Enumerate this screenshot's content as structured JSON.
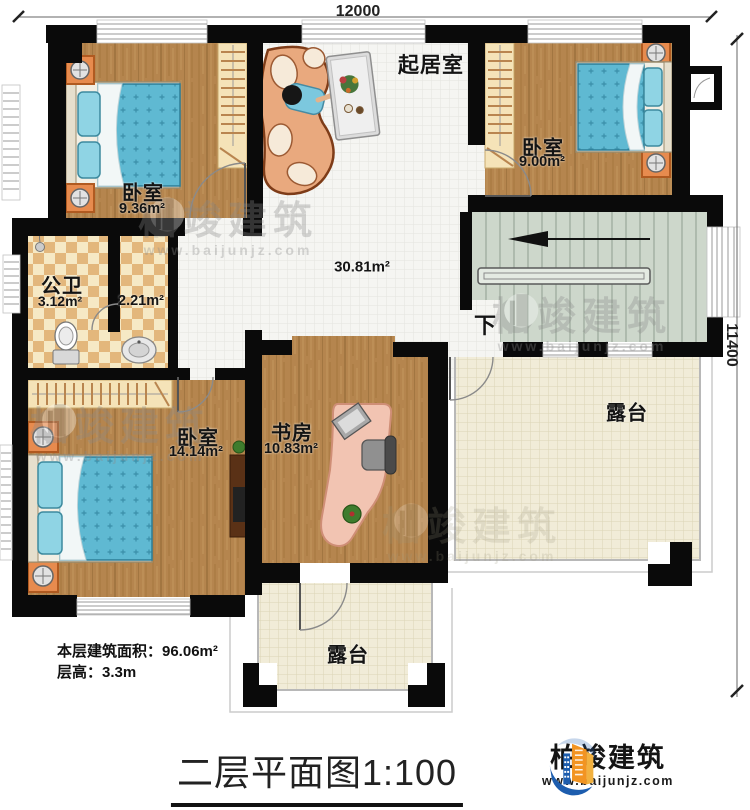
{
  "dimensions": {
    "width_label": "12000",
    "height_label": "11400"
  },
  "rooms": {
    "bedroom_tl": {
      "name": "卧室",
      "area": "9.36m²"
    },
    "living": {
      "name": "起居室",
      "area": "30.81m²"
    },
    "bedroom_tr": {
      "name": "卧室",
      "area": "9.00m²"
    },
    "bathroom": {
      "name": "公卫",
      "area": "3.12m²"
    },
    "washroom": {
      "area": "2.21m²"
    },
    "bedroom_bl": {
      "name": "卧室",
      "area": "14.14m²"
    },
    "study": {
      "name": "书房",
      "area": "10.83m²"
    },
    "terrace_right": {
      "name": "露台"
    },
    "terrace_bottom": {
      "name": "露台"
    }
  },
  "stairs": {
    "direction_label": "下"
  },
  "notes": {
    "building_area": "本层建筑面积：96.06m²",
    "floor_height": "层高：3.3m"
  },
  "title": {
    "name": "二层平面图",
    "scale": "1:100"
  },
  "brand": {
    "name": "柏竣建筑",
    "url": "www.baijunjz.com"
  },
  "watermark": {
    "name": "柏竣建筑",
    "url": "www.baijunjz.com"
  },
  "colors": {
    "wall": "#0a0a0a",
    "wood_floor": "#b5854e",
    "tile_floor": "#f5f5f2",
    "terrace_floor": "#f1ecd8",
    "bathroom_tile": "#e3b77c",
    "stair_floor": "#cdd7cb",
    "mattress_blue": "#5fb9d2",
    "furniture_orange": "#e78b4e",
    "brand_blue": "#1d5dae",
    "brand_orange": "#f29422"
  }
}
